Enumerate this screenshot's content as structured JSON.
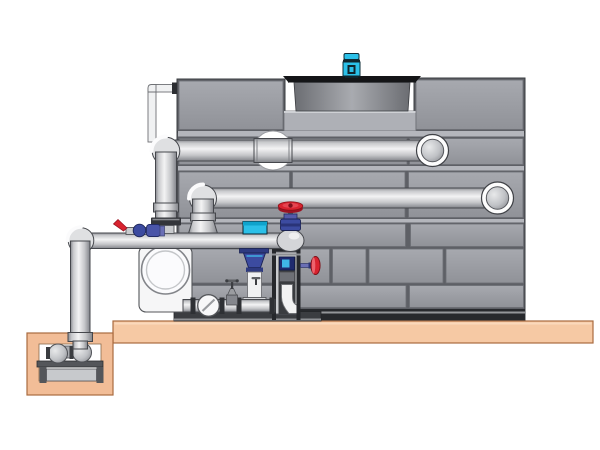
{
  "scene": {
    "kind": "cad-illustration",
    "subject": "cooling-tower-with-pump-and-piping",
    "background": "#ffffff",
    "colors": {
      "panel_base": "#5e6066",
      "panel_face_light": "#a7a9af",
      "panel_face_dark": "#909298",
      "panel_strip": "#b4b6bc",
      "panel_stroke": "#6b6d73",
      "tower_outline": "#3a3c40",
      "channel_dark": "#27292d",
      "channel_light": "#94969a",
      "recess_band": "#aeb0b6",
      "shroud_rim": "#141517",
      "shroud_dark": "#6b6d72",
      "shroud_light": "#a9abb0",
      "motor_cyan": "#2bc0e8",
      "motor_dark": "#10242c",
      "pipe_outline": "#45474c",
      "pipe_white": "#f0f1f2",
      "elbow_fill": "#dfe0e2",
      "ring_fill": "#fdfdfd",
      "ball_fill": "#b9bbbf",
      "slab_fill": "#f6c9a4",
      "slab_stroke": "#a96b3f",
      "pit_fill": "#f2bd97",
      "stand_dark": "#54565a",
      "stand_panel": "#c7c9cc",
      "skid_dark": "#3b3d41",
      "casing_white": "#f6f6f7",
      "casing_stroke": "#54565a",
      "frame_dark": "#26282c",
      "frame_face": "#c9cbce",
      "frame_inner": "#3a3c40",
      "box_blue": "#1f2a6e",
      "box_cyan": "#3fb6e8",
      "valve_red": "#d8232f",
      "valve_red_dark": "#9c1322",
      "valve_blue": "#3c4ba0",
      "valve_blue_mid": "#545aa8",
      "valve_flange": "#6a6fb5",
      "valve_navy": "#2a3478"
    },
    "components": [
      {
        "name": "cooling-tower-shell"
      },
      {
        "name": "fan-cowl"
      },
      {
        "name": "fan-motor"
      },
      {
        "name": "upper-supply-pipe"
      },
      {
        "name": "lower-return-pipe"
      },
      {
        "name": "makeup-line"
      },
      {
        "name": "suction-header"
      },
      {
        "name": "pump-volute"
      },
      {
        "name": "pump-skid"
      },
      {
        "name": "check-valve"
      },
      {
        "name": "globe-valve-red-handwheel"
      },
      {
        "name": "control-valve-cyan-actuator"
      },
      {
        "name": "bypass-ball-valve-red-lever"
      },
      {
        "name": "valve-stand-frame"
      },
      {
        "name": "side-red-handwheel"
      },
      {
        "name": "concrete-slab"
      },
      {
        "name": "sump-pit"
      },
      {
        "name": "sump-pump"
      }
    ]
  }
}
